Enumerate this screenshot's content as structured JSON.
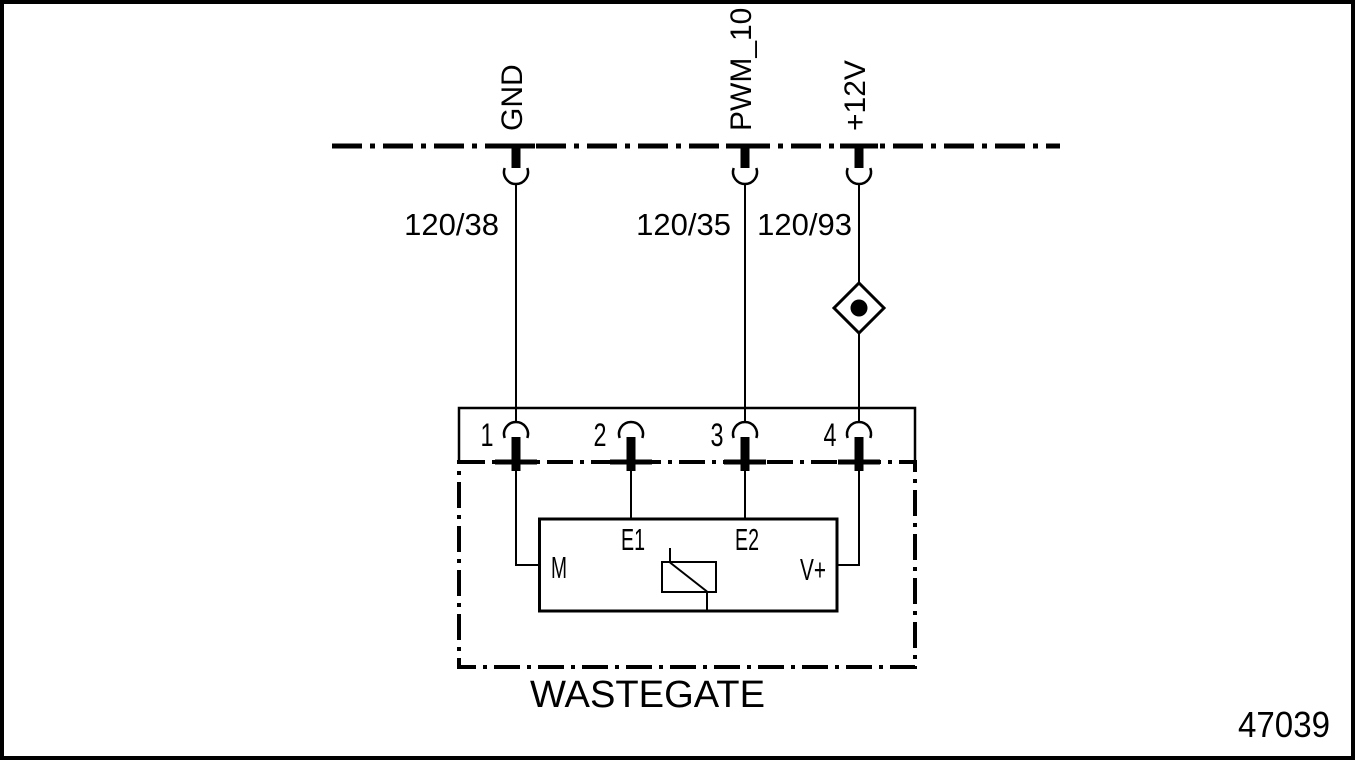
{
  "diagram": {
    "component": "WASTEGATE",
    "figure_number": "47039",
    "signals": [
      {
        "name": "GND",
        "wire_id": "120/38",
        "connector_pin": "1"
      },
      {
        "name": "PWM_10",
        "wire_id": "120/35",
        "connector_pin": "3"
      },
      {
        "name": "+12V",
        "wire_id": "120/93",
        "connector_pin": "4"
      }
    ],
    "connector_pins": [
      "1",
      "2",
      "3",
      "4"
    ],
    "terminals": [
      "M",
      "E1",
      "E2",
      "V+"
    ],
    "symbols": {
      "diamond_splice": "diamond-with-dot-connector",
      "solenoid": "coil-with-diagonal-symbol"
    },
    "colors": {
      "line": "#000000",
      "background": "#ffffff"
    }
  }
}
